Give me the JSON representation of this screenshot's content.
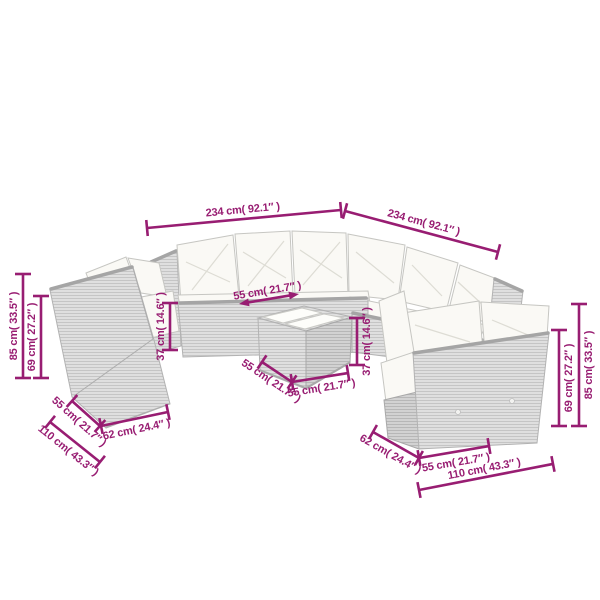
{
  "colors": {
    "accent": "#981D72",
    "background": "#FFFFFF",
    "rattan_gray": "#DFDFDF",
    "rattan_dark_gray": "#D2D2D2",
    "trim_gray": "#A5A5A5",
    "cushion_white": "#FAF9F5"
  },
  "scene": {
    "pieces": [
      "corner-sofa",
      "armless-chair",
      "coffee-table",
      "two-seater-sofa"
    ]
  },
  "dims": [
    {
      "name": "width-left",
      "text": "234 cm( 92.1″ )",
      "value_cm": 234,
      "value_inch": 92.1
    },
    {
      "name": "width-right",
      "text": "234 cm( 92.1″ )",
      "value_cm": 234,
      "value_inch": 92.1
    },
    {
      "name": "total-height-left",
      "text": "85 cm( 33.5″ )",
      "value_cm": 85,
      "value_inch": 33.5
    },
    {
      "name": "back-height-left",
      "text": "69 cm( 27.2″ )",
      "value_cm": 69,
      "value_inch": 27.2
    },
    {
      "name": "seat-height-left",
      "text": "37 cm( 14.6″ )",
      "value_cm": 37,
      "value_inch": 14.6
    },
    {
      "name": "seat-depth",
      "text": "55 cm( 21.7″ )",
      "value_cm": 55,
      "value_inch": 21.7
    },
    {
      "name": "table-depth",
      "text": "55 cm( 21.7″ )",
      "value_cm": 55,
      "value_inch": 21.7
    },
    {
      "name": "table-width",
      "text": "55 cm( 21.7″ )",
      "value_cm": 55,
      "value_inch": 21.7
    },
    {
      "name": "table-height",
      "text": "37 cm( 14.6″ )",
      "value_cm": 37,
      "value_inch": 14.6
    },
    {
      "name": "chair-seat-width",
      "text": "55 cm( 21.7″ )",
      "value_cm": 55,
      "value_inch": 21.7
    },
    {
      "name": "chair-depth",
      "text": "62 cm( 24.4″ )",
      "value_cm": 62,
      "value_inch": 24.4
    },
    {
      "name": "chair-width",
      "text": "110 cm( 43.3″ )",
      "value_cm": 110,
      "value_inch": 43.3
    },
    {
      "name": "sofa-depth-right",
      "text": "62 cm( 24.4″ )",
      "value_cm": 62,
      "value_inch": 24.4
    },
    {
      "name": "sofa-seat-width-right",
      "text": "55 cm( 21.7″ )",
      "value_cm": 55,
      "value_inch": 21.7
    },
    {
      "name": "sofa-width-right",
      "text": "110 cm( 43.3″ )",
      "value_cm": 110,
      "value_inch": 43.3
    },
    {
      "name": "back-height-right",
      "text": "69 cm( 27.2″ )",
      "value_cm": 69,
      "value_inch": 27.2
    },
    {
      "name": "total-height-right",
      "text": "85 cm( 33.5″ )",
      "value_cm": 85,
      "value_inch": 33.5
    }
  ]
}
